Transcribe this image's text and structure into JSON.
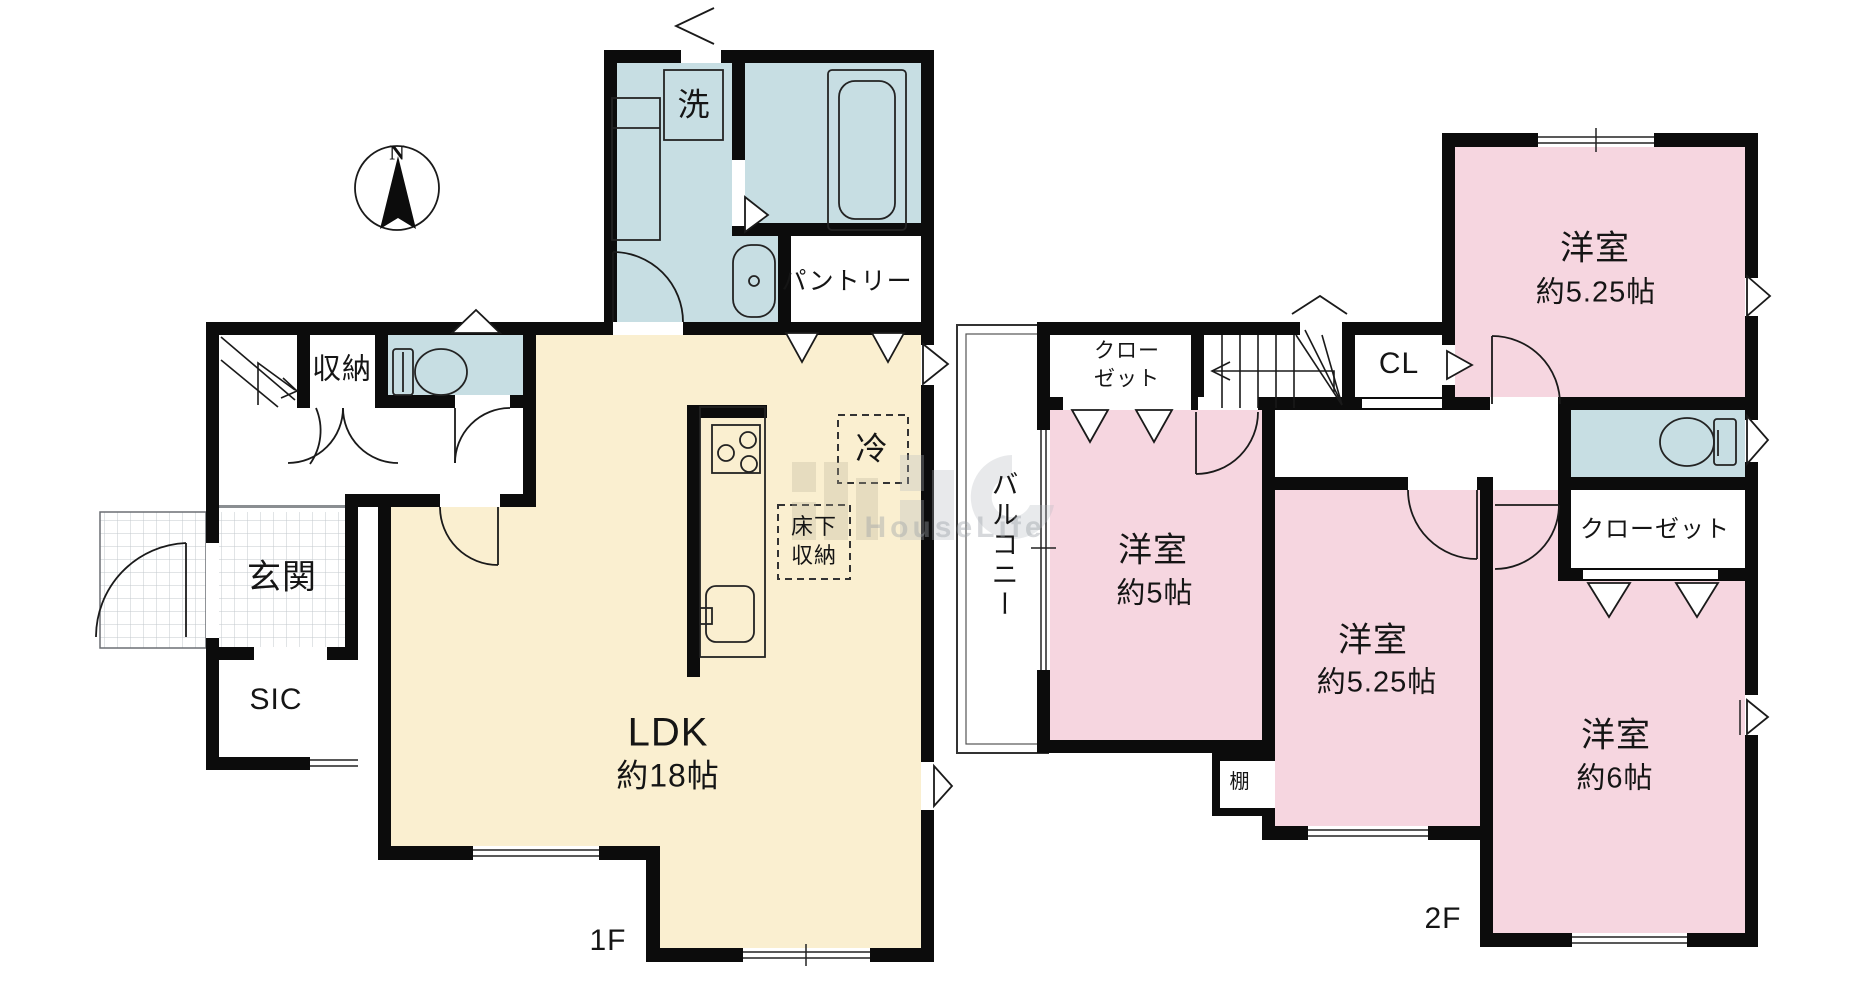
{
  "document": {
    "kind": "floor-plan",
    "compass_label": "N"
  },
  "watermark": {
    "text": "HouseLife"
  },
  "floor1": {
    "floor_label": "1F",
    "rooms": {
      "laundry": "洗",
      "pantry": "パントリー",
      "storage": "収納",
      "entrance": "玄関",
      "shoe_closet": "SIC",
      "ldk_name": "LDK",
      "ldk_size": "約18帖",
      "refrigerator": "冷",
      "underfloor_storage_line1": "床下",
      "underfloor_storage_line2": "収納"
    }
  },
  "floor2": {
    "floor_label": "2F",
    "rooms": {
      "balcony": "バルコニー",
      "closet_top_line1": "クロー",
      "closet_top_line2": "ゼット",
      "cl": "CL",
      "bedroom_ne_name": "洋室",
      "bedroom_ne_size": "約5.25帖",
      "closet_east": "クローゼット",
      "bedroom_w_name": "洋室",
      "bedroom_w_size": "約5帖",
      "bedroom_c_name": "洋室",
      "bedroom_c_size": "約5.25帖",
      "bedroom_se_name": "洋室",
      "bedroom_se_size": "約6帖",
      "shelf": "棚"
    }
  }
}
